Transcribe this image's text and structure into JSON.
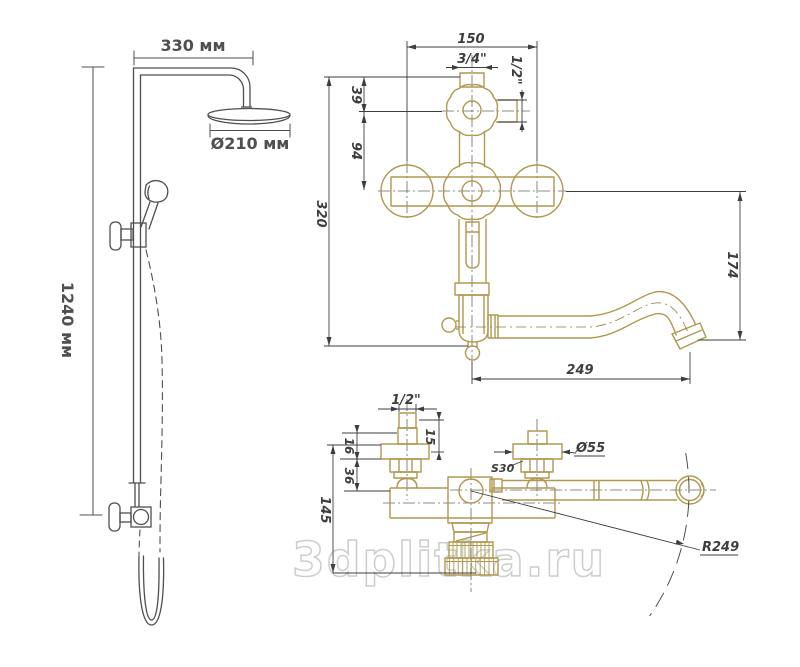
{
  "watermark": "3dplitka.ru",
  "colors": {
    "gold": "#b0984e",
    "dim": "#3e3e3e",
    "gray": "#4f4f4f",
    "watermark": "#cdcdcd"
  },
  "left_view": {
    "width_label": "330 мм",
    "diameter_label": "Ø210 мм",
    "height_label": "1240 мм"
  },
  "front_view": {
    "width": "150",
    "thread_top": "3/4\"",
    "thread_side": "1/2\"",
    "offset_top": "39",
    "offset_mid": "94",
    "height": "320",
    "spout_drop": "174",
    "spout_reach": "249"
  },
  "top_view": {
    "thread": "1/2\"",
    "dim_15": "15",
    "dim_16": "16",
    "dim_36": "36",
    "height": "145",
    "wrench_size": "S30",
    "flange_diameter": "Ø55",
    "swing_radius": "R249"
  }
}
